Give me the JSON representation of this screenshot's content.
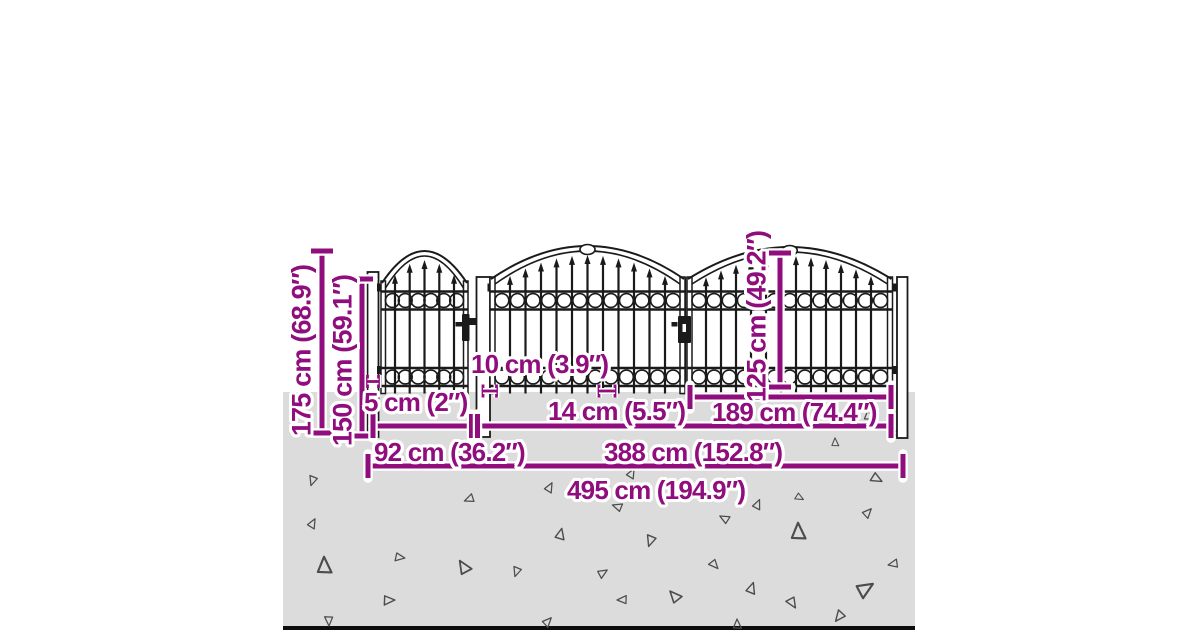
{
  "dimensions": {
    "overall_height": "175 cm (68.9″)",
    "fence_height": "150 cm (59.1″)",
    "infill_height": "125 cm (49.2″)",
    "post_width": "5 cm (2″)",
    "hinge_post_width": "10 cm (3.9″)",
    "bar_spacing": "14 cm (5.5″)",
    "leaf_width": "189 cm (74.4″)",
    "single_gate_width": "92 cm (36.2″)",
    "double_gate_width": "388 cm (152.8″)",
    "total_width": "495 cm (194.9″)"
  },
  "colors": {
    "dimension_accent": "#900d7d",
    "fence_ink": "#1a1a1a",
    "ground_fill": "#dcdcdc",
    "gravel_outline": "#4c4c4c"
  }
}
